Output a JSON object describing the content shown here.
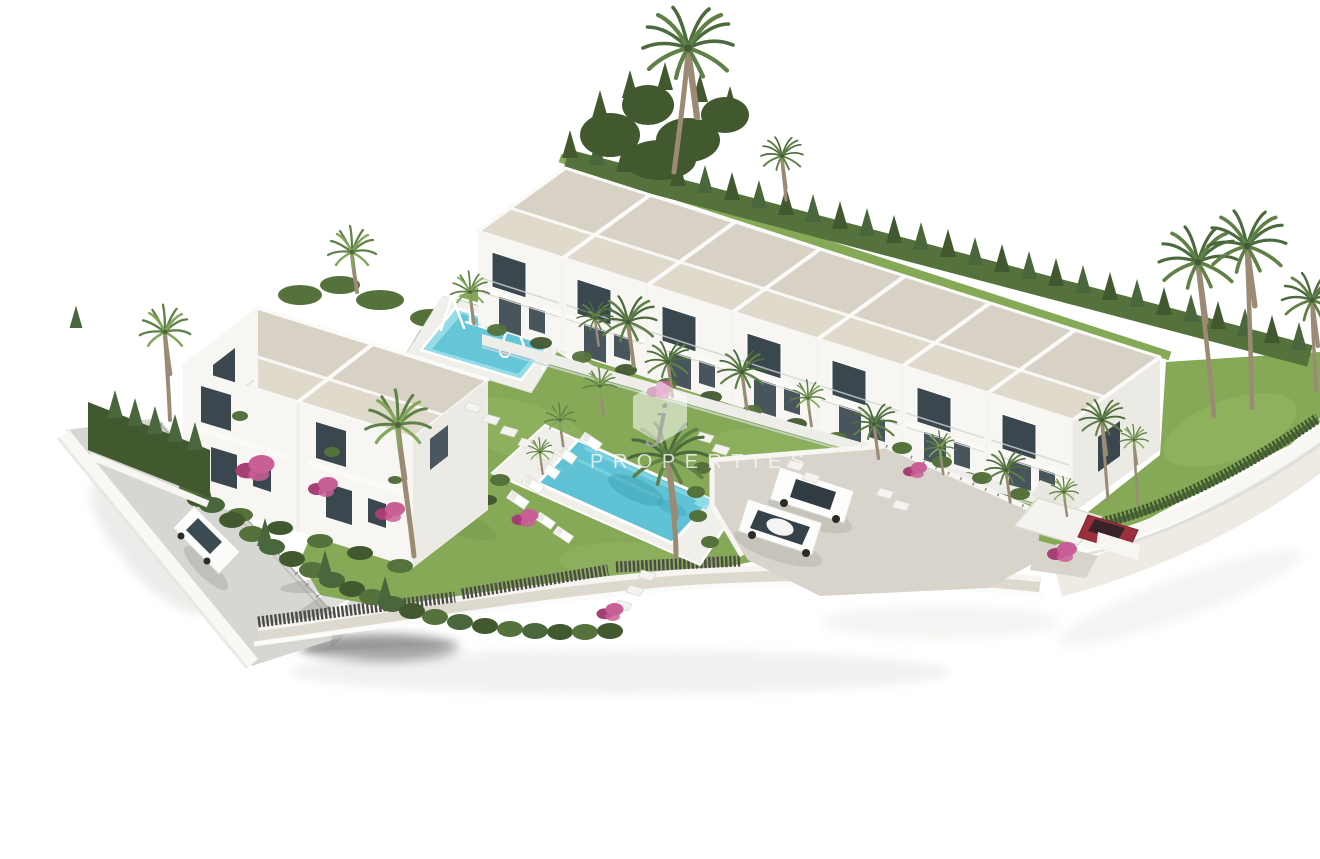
{
  "image": {
    "kind": "architectural-3d-render",
    "description": "Aerial 3D visualisation of a new-build white residential development: a row of terraced townhouses, a semi-detached two-storey block, communal gardens with two swimming pools, palm trees, hedged perimeter, access road and parking court",
    "background": "#ffffff"
  },
  "watermark": {
    "logo_shape": "hexagon",
    "logo_letter": "j",
    "brand_text": "PROPERTIES",
    "visible_part": "OPERTIES"
  },
  "palette": {
    "bg": "#ffffff",
    "wallWhite": "#f7f6f2",
    "wallShade": "#eceae5",
    "roofBeige": "#d8d2c6",
    "roofBeige2": "#e0dacd",
    "windowDark": "#3a474f",
    "grass": "#85a957",
    "grassLight": "#9cbd6a",
    "hedge": "#55713c",
    "hedgeDark": "#42592f",
    "conifer": "#4a663c",
    "palmGreen": "#5f8147",
    "palmLight": "#83a75b",
    "palmDark": "#4c6b3d",
    "trunk": "#9b8b74",
    "poolWater": "#5fc3d5",
    "poolLight": "#94dde8",
    "poolDeep": "#3da2b6",
    "deck": "#f1efe9",
    "pave": "#d8d4cb",
    "road": "#d6d6d3",
    "fenceDark": "#4c4b47",
    "wire": "#8f8f8b",
    "pink": "#c95f97",
    "pinkDark": "#a63f75",
    "carRed": "#9c2f3d"
  },
  "scene": {
    "townhouse_row": {
      "name": "terraced-townhouses",
      "units": 7,
      "storeys": 2
    },
    "left_building": {
      "name": "semi-detached-houses",
      "units": 2,
      "storeys": 2
    },
    "kids_pool": {
      "name": "kids-pool-with-swing-set"
    },
    "main_pool": {
      "name": "communal-lap-pool",
      "sun_loungers": 7
    },
    "parking": {
      "name": "parking-court",
      "cars": [
        "white-estate",
        "white-sedan"
      ]
    },
    "street": {
      "name": "access-road",
      "cars": [
        "white-hatchback"
      ]
    },
    "carport": {
      "name": "carport",
      "cars": [
        "red-car"
      ]
    },
    "landscaping": {
      "palm_trees": 25,
      "perimeter": "clipped hedges and slatted fence",
      "flowers": "pink bougainvillea"
    }
  }
}
